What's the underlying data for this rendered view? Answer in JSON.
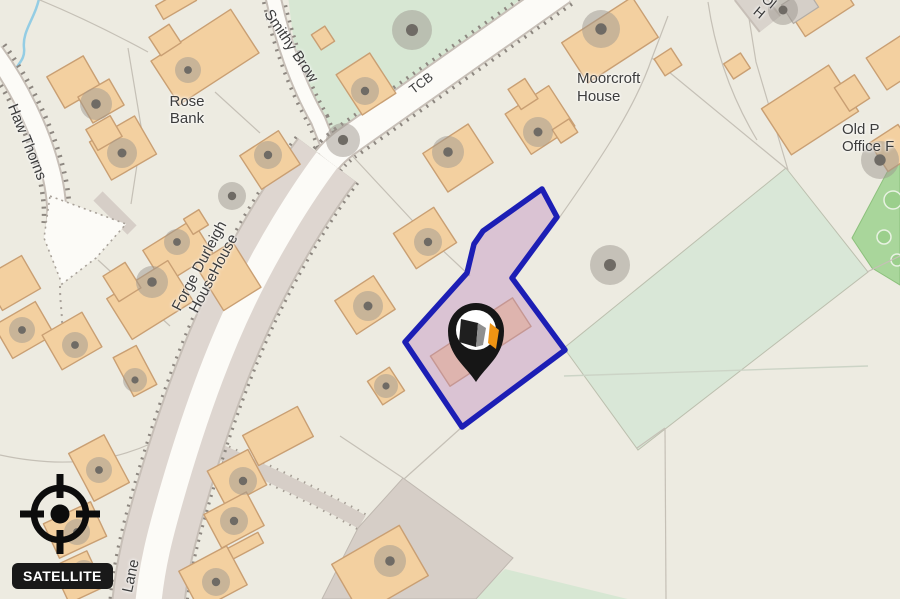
{
  "map": {
    "place_labels": {
      "rose_bank": {
        "line1": "Rose",
        "line2": "Bank"
      },
      "moorcroft_house": {
        "line1": "Moorcroft",
        "line2": "House"
      },
      "old_post_office": {
        "line1": "Old P",
        "line2": "Office F"
      },
      "forge_durleigh": {
        "line1": "Forge Durleigh",
        "line2": "HouseHouse"
      },
      "top_right_partial": {
        "line1": "Ol",
        "line2": "H"
      },
      "tcb": "TCB"
    },
    "road_labels": {
      "haw_thorns": "Haw Thorns",
      "smithy_brow": "Smithy Brow",
      "lane": "Lane"
    },
    "selected_parcel": {
      "outline_color": "#1c1eb5",
      "fill_color": "#c08cc0"
    },
    "marker": {
      "pin_color": "#161616",
      "logo_black": "#1f1f1f",
      "logo_gray": "#8f8f8f",
      "logo_orange": "#ef9413"
    }
  },
  "controls": {
    "satellite_button_label": "SATELLITE"
  },
  "theme": {
    "background": "#edebe1",
    "building_fill": "#f3d0a0",
    "building_stroke": "#c99f73",
    "building_gray_fill": "#d5cfc8",
    "tree_gray": "#9d988f",
    "tree_dot": "#6f6b65",
    "road_fill": "#fcfbf7",
    "road_casing": "#c7bfb7",
    "road_shoulder": "#ded6d0",
    "road_dash": "#8d8780",
    "boundary_line": "#c5c0b6",
    "green_field": "#d9e7d7",
    "green_area": "#d7e7d3",
    "green_wood": "#a9d69b",
    "farmyard": "#d6cec7",
    "stream_blue": "#94cde4",
    "label_color": "#3c3c3c",
    "button_bg": "#191919",
    "button_text": "#ffffff",
    "crosshair": "#0c0c0c"
  }
}
